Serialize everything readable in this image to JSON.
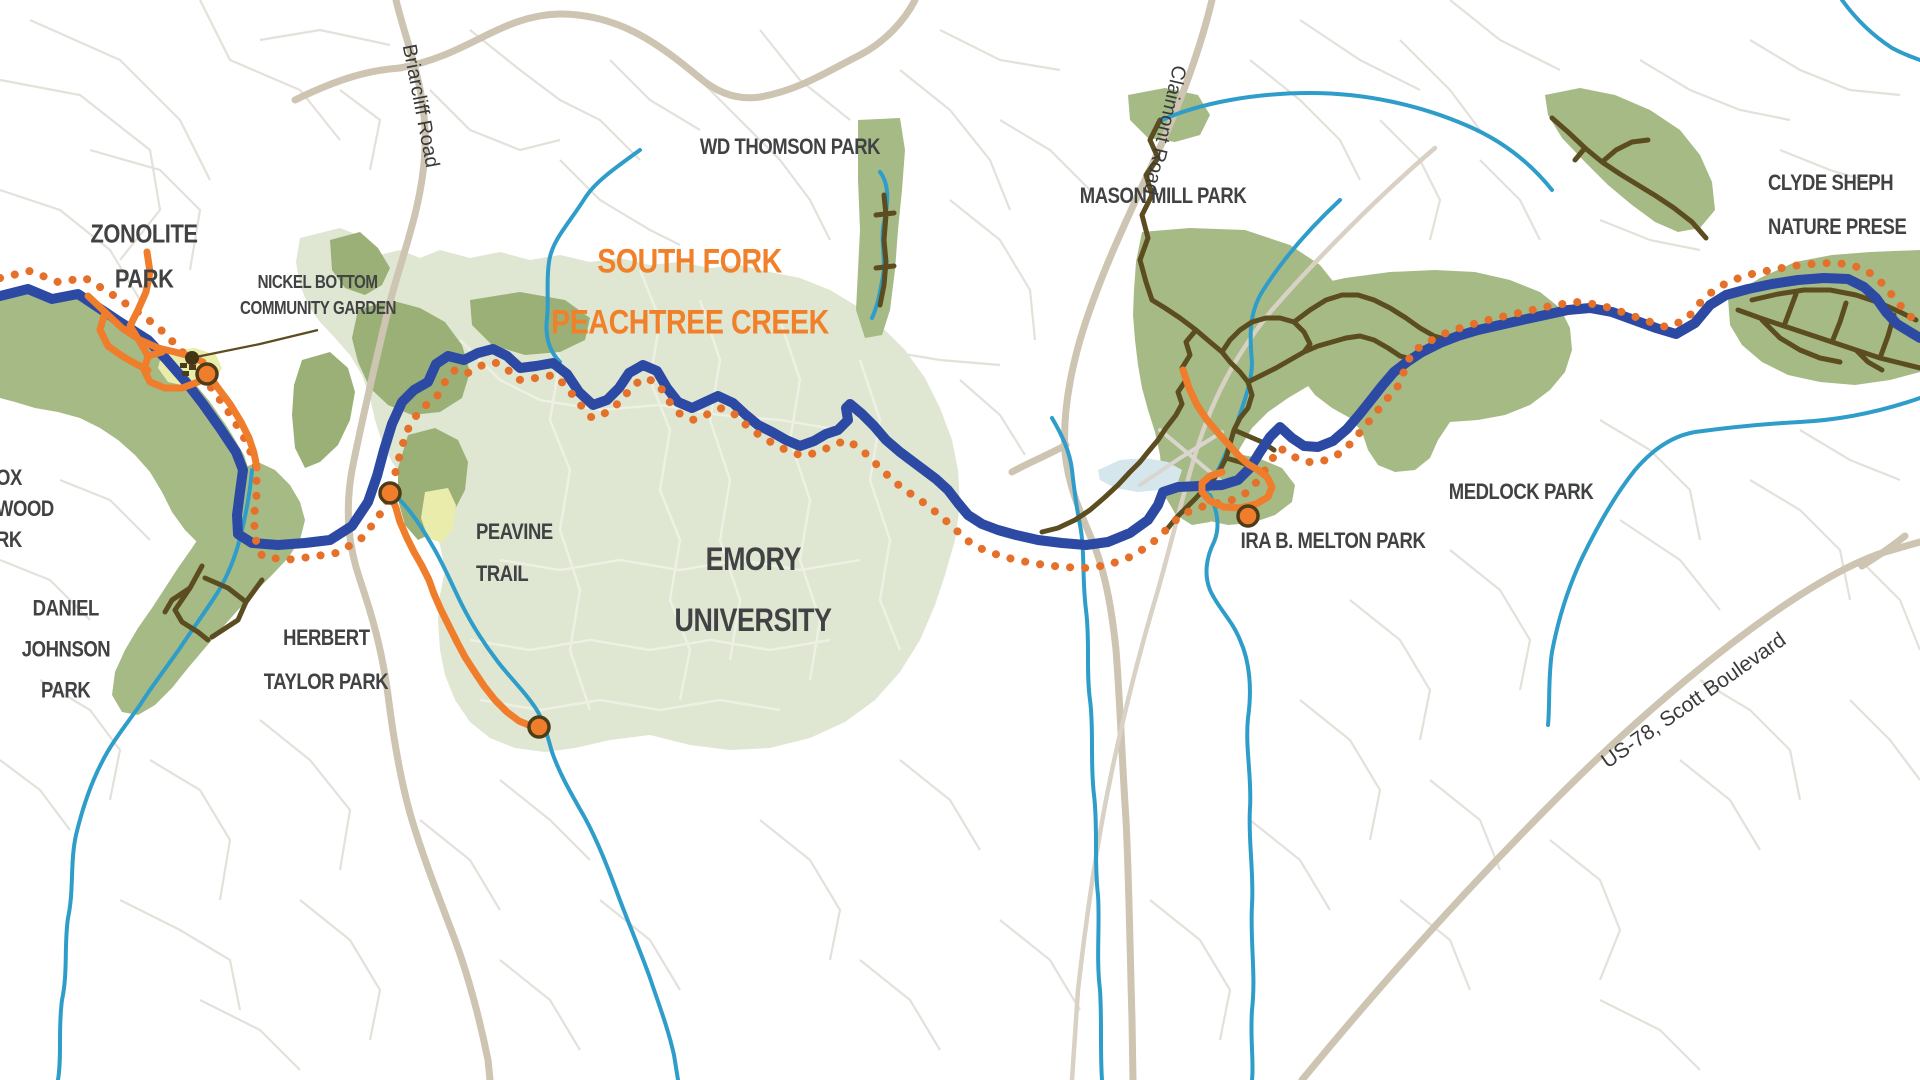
{
  "map_title": {
    "line1": "SOUTH FORK",
    "line2": "PEACHTREE CREEK"
  },
  "park_labels": {
    "zonolite": [
      "ZONOLITE",
      "PARK"
    ],
    "nickel_bottom": [
      "NICKEL BOTTOM",
      "COMMUNITY GARDEN"
    ],
    "wd_thomson": "WD THOMSON PARK",
    "mason_mill": "MASON MILL PARK",
    "clyde_shepherd": [
      "CLYDE SHEPH",
      "NATURE PRESE"
    ],
    "medlock": "MEDLOCK PARK",
    "ira_melton": "IRA B. MELTON PARK",
    "emory": [
      "EMORY",
      "UNIVERSITY"
    ],
    "peavine": [
      "PEAVINE",
      "TRAIL"
    ],
    "herbert_taylor": [
      "HERBERT",
      "TAYLOR PARK"
    ],
    "daniel_johnson": [
      "DANIEL",
      "JOHNSON",
      "PARK"
    ],
    "west_edge_partial": [
      "OX",
      "WOOD",
      "RK"
    ]
  },
  "road_labels": {
    "briarcliff": "Briarcliff Road",
    "claimont": "Claimont Road",
    "us78": "US-78, Scott Boulevard"
  },
  "palette": {
    "bg": "#ffffff",
    "street": "#e3e1da",
    "campus_street": "#edf0e2",
    "road_tan": "#cdc4b2",
    "railroad": "#d8d1c4",
    "park_green": "#a6ba85",
    "woods_green": "#9bb077",
    "campus_green": "#dfe6d1",
    "garden_yellow": "#e9ecab",
    "pond_blue": "#d5e6ec",
    "creek_teal": "#2f9dc9",
    "trail_proposed_blue": "#2c49a4",
    "trail_study_orange": "#e4702a",
    "trail_orange": "#ef7d2b",
    "trail_existing_brown": "#5c4d20",
    "label_dark": "#414243",
    "title_orange": "#f0802a"
  }
}
